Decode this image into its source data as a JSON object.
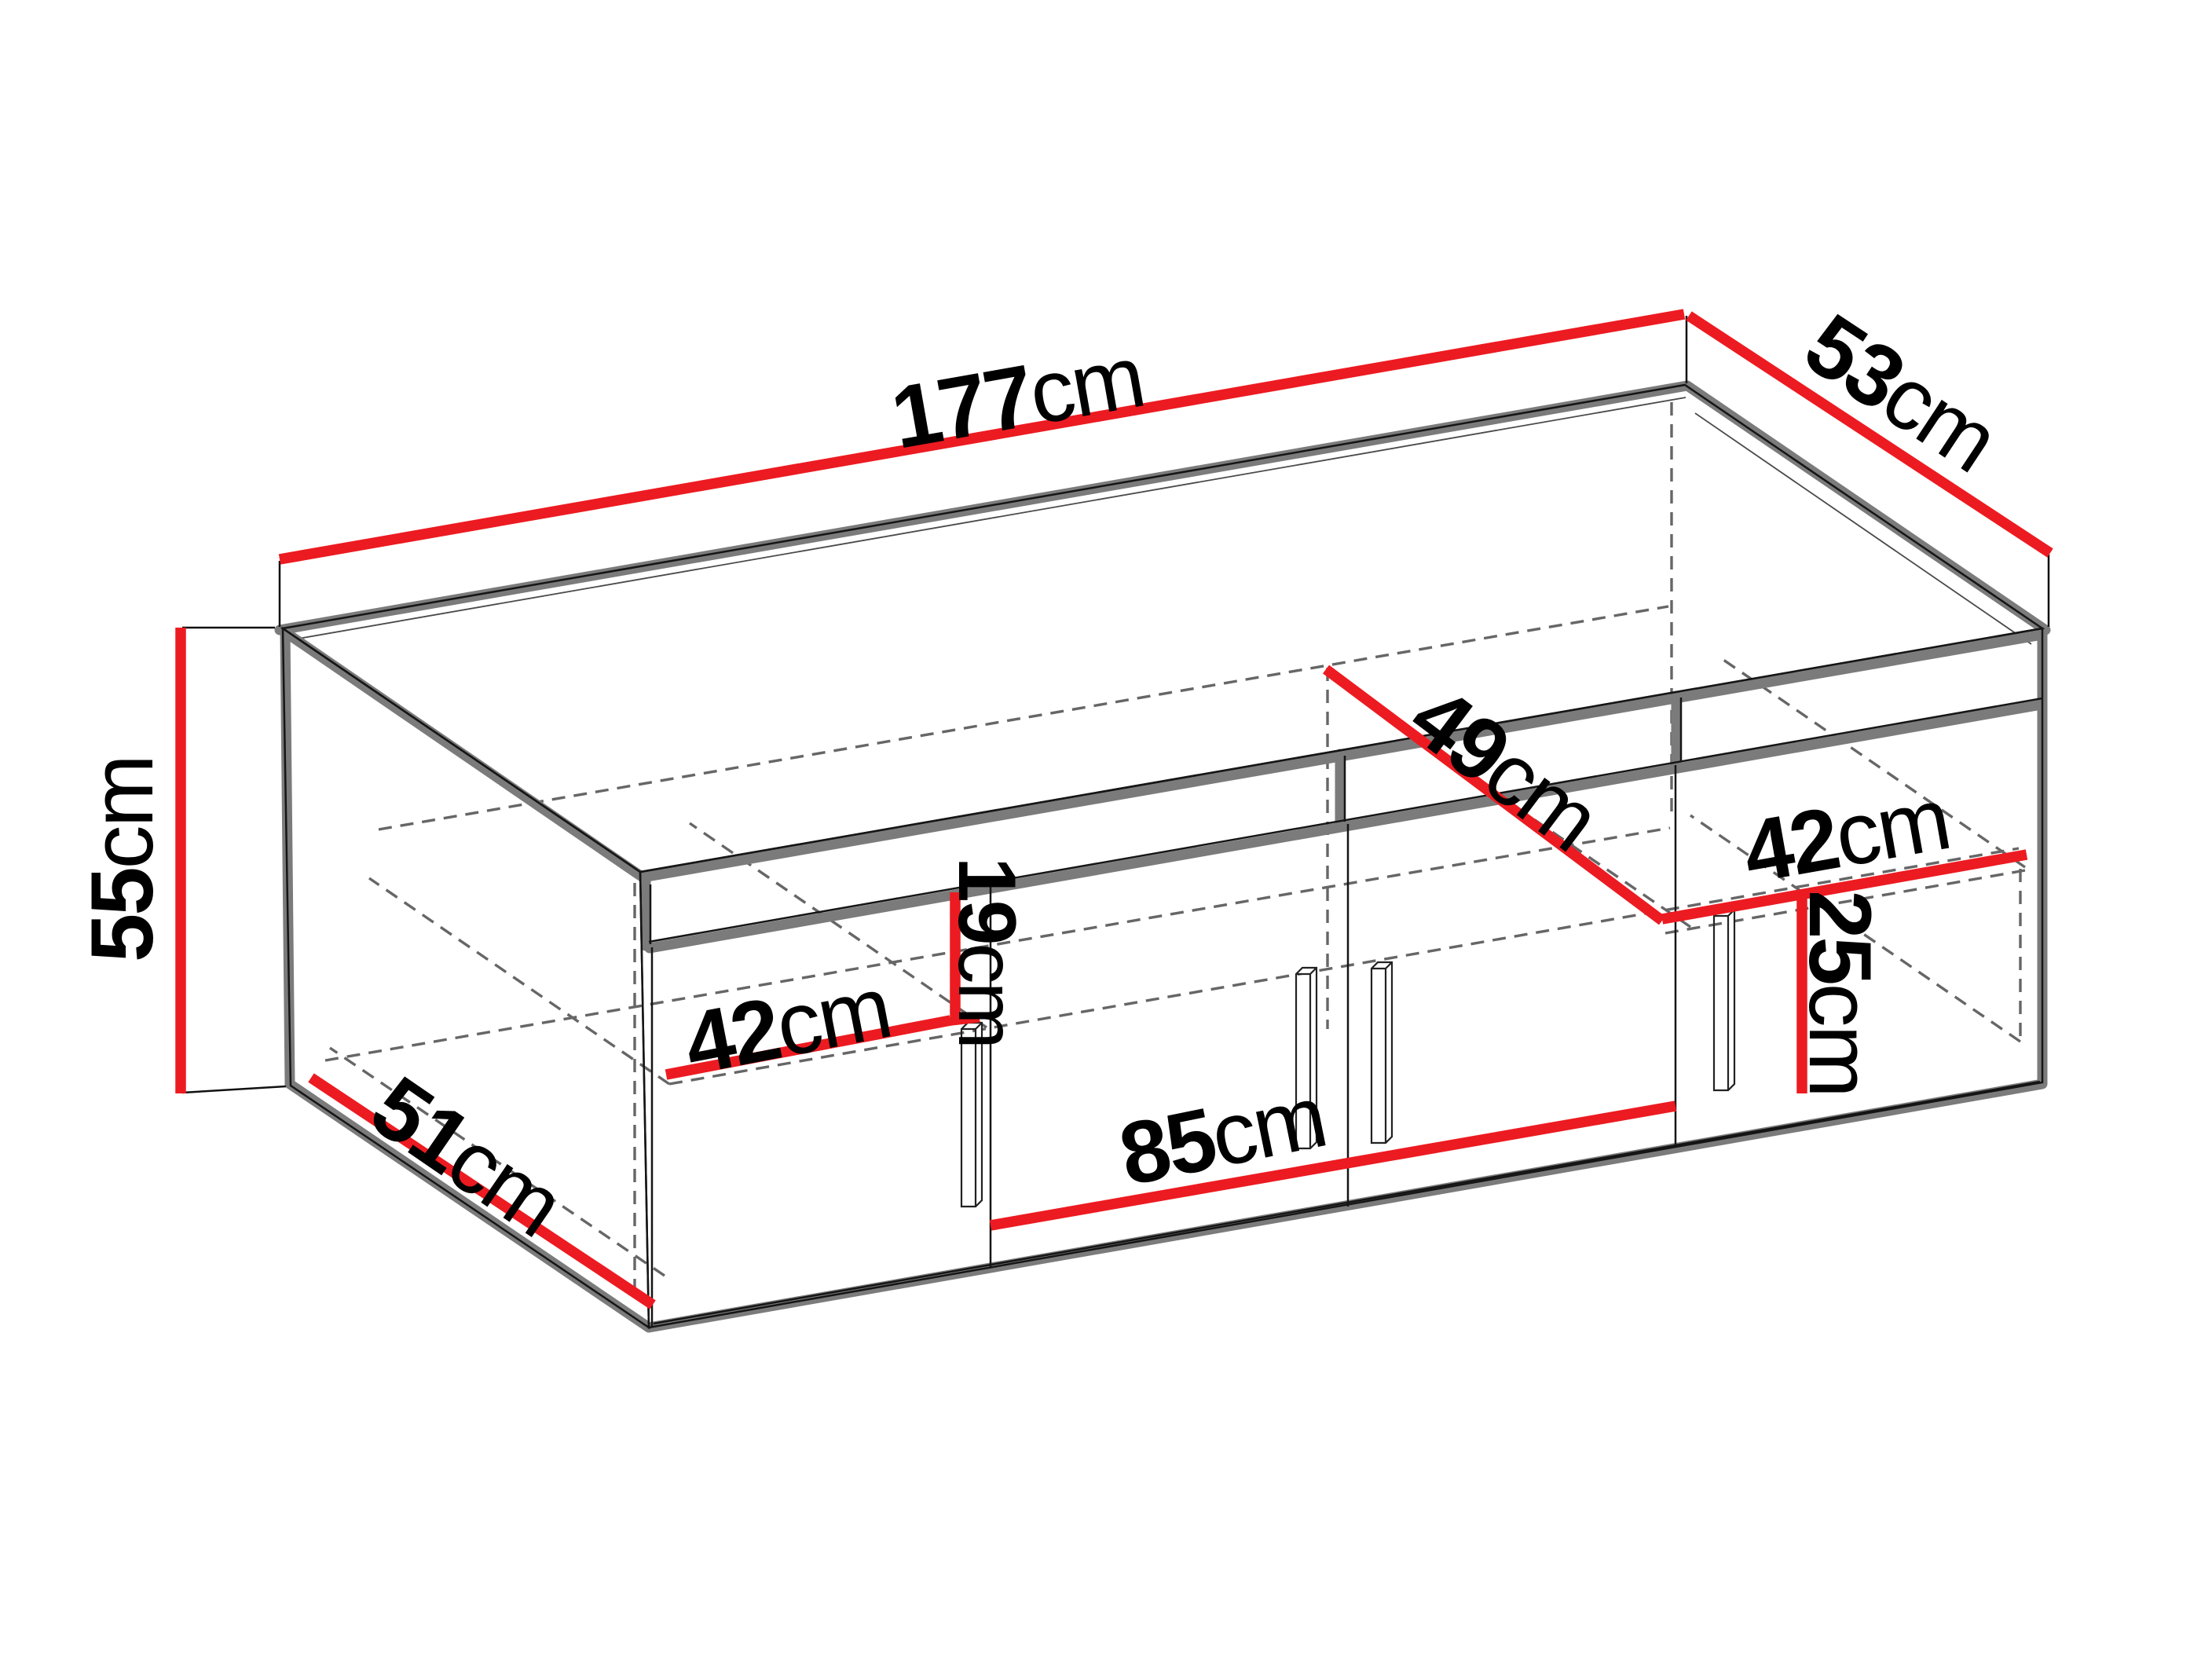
{
  "diagram": {
    "kind": "furniture dimension diagram",
    "subject": "four-door sideboard cabinet in oblique 3D view with red dimension lines"
  },
  "colors": {
    "dimension_line": "#ec1b21",
    "edge_shadow": "#7b7b7b",
    "outline": "#151515",
    "hidden_line": "#666666",
    "background": "#ffffff"
  },
  "dims": {
    "width": {
      "value": "177",
      "unit": "cm"
    },
    "top_depth": {
      "value": "53",
      "unit": "cm"
    },
    "height": {
      "value": "55",
      "unit": "cm"
    },
    "inner_depth": {
      "value": "49",
      "unit": "cm"
    },
    "left_inner_width": {
      "value": "42",
      "unit": "cm"
    },
    "niche_height": {
      "value": "19",
      "unit": "cm"
    },
    "right_inner_width": {
      "value": "42",
      "unit": "cm"
    },
    "right_shelf_height": {
      "value": "25",
      "unit": "cm"
    },
    "middle_width": {
      "value": "85",
      "unit": "cm"
    },
    "bottom_depth": {
      "value": "51",
      "unit": "cm"
    }
  }
}
